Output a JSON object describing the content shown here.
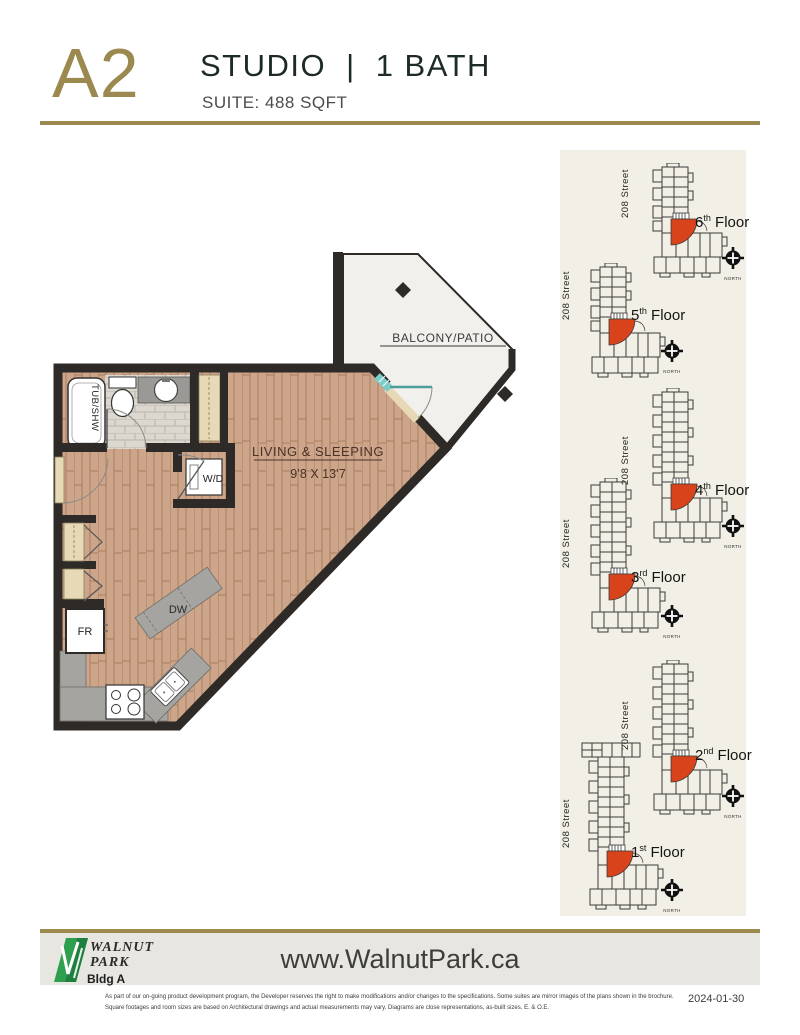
{
  "header": {
    "plan_code": "A2",
    "unit_type": "STUDIO",
    "separator": "|",
    "bath": "1 BATH",
    "suite": "SUITE: 488 SQFT"
  },
  "floor_plan": {
    "balcony_label": "BALCONY/PATIO",
    "room_label": "LIVING & SLEEPING",
    "room_dims": "9’8 X 13’7",
    "tub_label": "TUB/SHW",
    "wd_label": "W/D",
    "dw_label": "DW",
    "fr_label": "FR"
  },
  "key_plans": [
    {
      "floor_number": "6",
      "ordinal": "th",
      "floor_word": " Floor",
      "street": "208 Street",
      "north": "NORTH"
    },
    {
      "floor_number": "5",
      "ordinal": "th",
      "floor_word": " Floor",
      "street": "208 Street",
      "north": "NORTH"
    },
    {
      "floor_number": "4",
      "ordinal": "th",
      "floor_word": " Floor",
      "street": "208 Street",
      "north": "NORTH"
    },
    {
      "floor_number": "3",
      "ordinal": "rd",
      "floor_word": " Floor",
      "street": "208 Street",
      "north": "NORTH"
    },
    {
      "floor_number": "2",
      "ordinal": "nd",
      "floor_word": " Floor",
      "street": "208 Street",
      "north": "NORTH"
    },
    {
      "floor_number": "1",
      "ordinal": "st",
      "floor_word": " Floor",
      "street": "208 Street",
      "north": "NORTH"
    }
  ],
  "footer": {
    "brand_line1": "WALNUT",
    "brand_line2": "PARK",
    "building": "Bldg A",
    "website": "www.WalnutPark.ca",
    "disclaimer_line1": "As part of our on-going product development program, the Developer reserves the right to make modifications and/or changes to the specifications. Some suites are mirror images of the plans shown in the brochure.",
    "disclaimer_line2": "Square footages and room sizes are based on Architectural drawings and actual measurements may vary. Diagrams are close representations, as-built sizes. E. & O.E.",
    "date": "2024-01-30"
  },
  "colors": {
    "gold": "#9c8950",
    "wall": "#2d2a27",
    "wood": "#cda58a",
    "tile": "#dcd8d0",
    "counter": "#a5a4a0",
    "closet_beige": "#e7d9b5",
    "balcony_fill": "#f2f0ed",
    "unit_red": "#d8431c",
    "panel_cream": "#f2efe6",
    "logo_green": "#2e9e4f",
    "footer_gray": "#e8e6e1"
  }
}
